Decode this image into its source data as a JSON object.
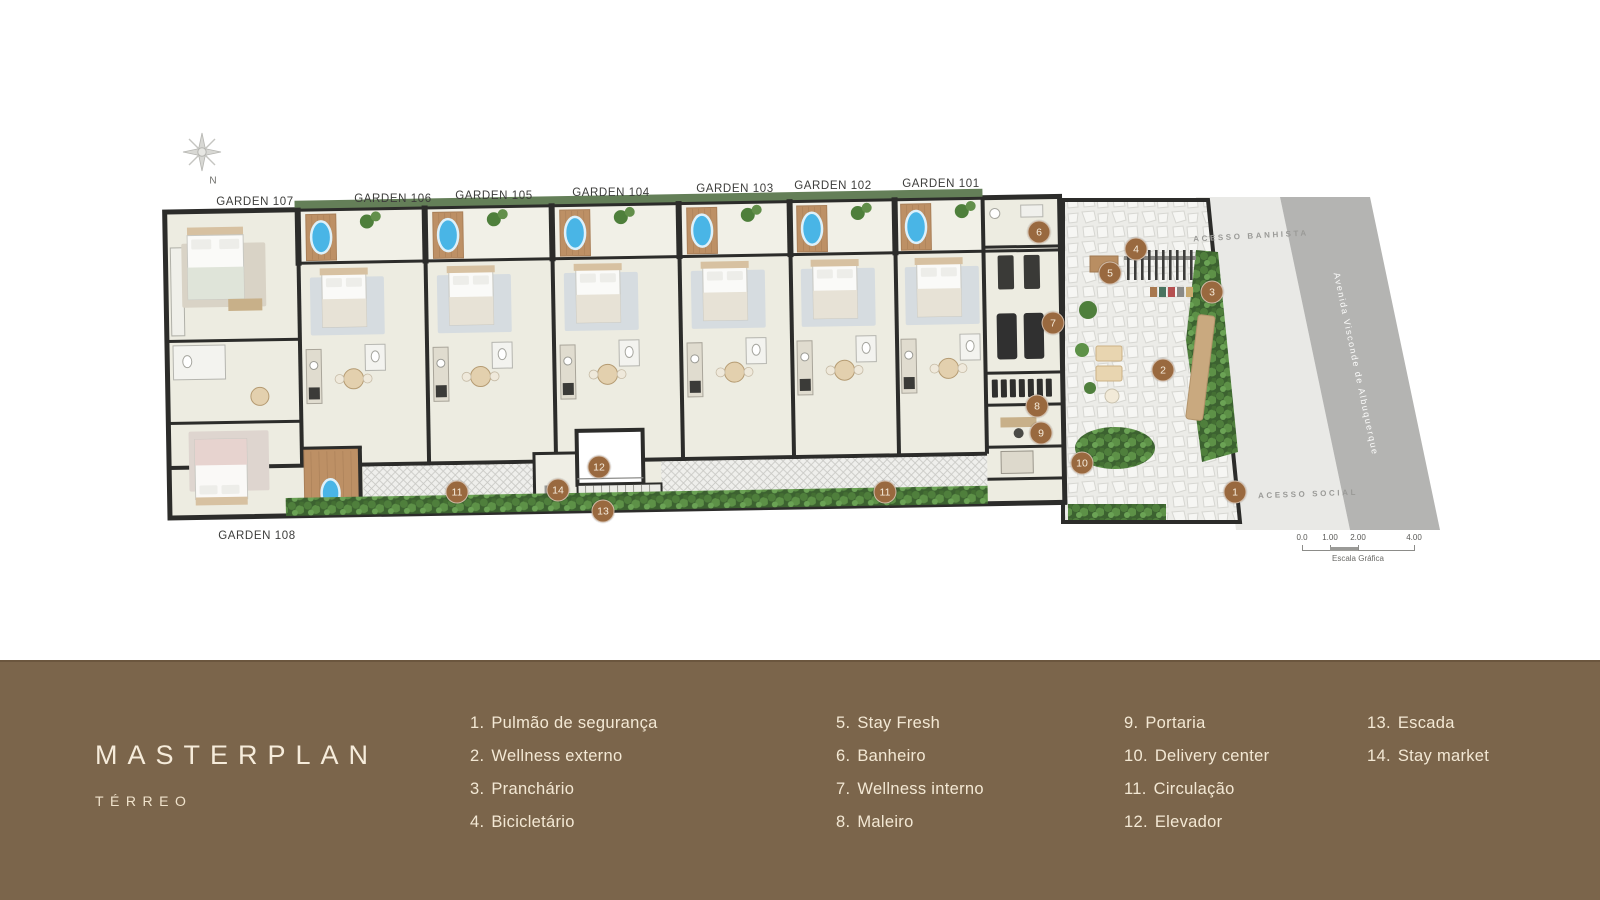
{
  "plan": {
    "compass_label": "N",
    "garden_labels": [
      {
        "label": "GARDEN 107"
      },
      {
        "label": "GARDEN 106"
      },
      {
        "label": "GARDEN 105"
      },
      {
        "label": "GARDEN 104"
      },
      {
        "label": "GARDEN 103"
      },
      {
        "label": "GARDEN 102"
      },
      {
        "label": "GARDEN 101"
      },
      {
        "label": "GARDEN 108"
      }
    ],
    "access_labels": {
      "top": "ACESSO BANHISTA",
      "bottom": "ACESSO SOCIAL"
    },
    "street_name": "Avenida Visconde de Albuquerque",
    "markers": [
      {
        "number": "1"
      },
      {
        "number": "2"
      },
      {
        "number": "3"
      },
      {
        "number": "4"
      },
      {
        "number": "5"
      },
      {
        "number": "6"
      },
      {
        "number": "7"
      },
      {
        "number": "8"
      },
      {
        "number": "9"
      },
      {
        "number": "10"
      },
      {
        "number": "11"
      },
      {
        "number": "12"
      },
      {
        "number": "13"
      },
      {
        "number": "14"
      },
      {
        "number": "11"
      }
    ],
    "scale_bar": {
      "ticks": [
        "0.0",
        "1.00",
        "2.00",
        "4.00"
      ],
      "caption": "Escala Gráfica"
    }
  },
  "footer": {
    "title": "MASTERPLAN",
    "subtitle": "TÉRREO",
    "legend": {
      "columns": [
        {
          "items": [
            {
              "number": "1.",
              "label": "Pulmão de segurança"
            },
            {
              "number": "2.",
              "label": "Wellness externo"
            },
            {
              "number": "3.",
              "label": "Pranchário"
            },
            {
              "number": "4.",
              "label": "Bicicletário"
            }
          ]
        },
        {
          "items": [
            {
              "number": "5.",
              "label": "Stay Fresh"
            },
            {
              "number": "6.",
              "label": "Banheiro"
            },
            {
              "number": "7.",
              "label": "Wellness interno"
            },
            {
              "number": "8.",
              "label": "Maleiro"
            }
          ]
        },
        {
          "items": [
            {
              "number": "9.",
              "label": "Portaria"
            },
            {
              "number": "10.",
              "label": "Delivery center"
            },
            {
              "number": "11.",
              "label": "Circulação"
            },
            {
              "number": "12.",
              "label": "Elevador"
            }
          ]
        },
        {
          "items": [
            {
              "number": "13.",
              "label": "Escada"
            },
            {
              "number": "14.",
              "label": "Stay market"
            }
          ]
        }
      ]
    }
  },
  "colors": {
    "footer_bg": "#7b654b",
    "footer_text": "#f3e8d4",
    "marker_bg": "#99693f",
    "wall": "#2c2c2a",
    "floor": "#edece1",
    "pool": "#49b5e6",
    "hedge_green": "#4f7f3c",
    "road": "#b4b4b2",
    "sidewalk": "#e9e9e6"
  }
}
